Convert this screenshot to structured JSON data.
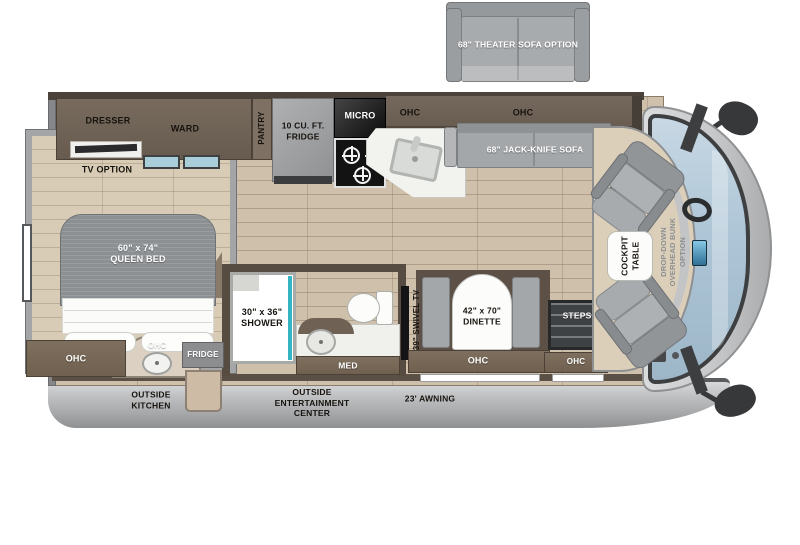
{
  "colors": {
    "cabinet_brown": "#6b5e52",
    "floor_wood": "#cfc0ab",
    "seat_gray": "#a3a6a8",
    "windshield_blue": "#a9c2d3",
    "skirt_gray": "#b9bbbd",
    "accent_teal": "#35b4c4"
  },
  "floorplan": {
    "options": {
      "theater_sofa": "68\" THEATER SOFA OPTION",
      "tv_option": "TV OPTION",
      "cockpit_table": "COCKPIT\nTABLE",
      "bunk_option": "DROP-DOWN\nOVERHEAD BUNK\nOPTION"
    },
    "galley": {
      "dresser": "DRESSER",
      "ward": "WARD",
      "pantry": "PANTRY",
      "fridge": "10 CU. FT.\nFRIDGE",
      "micro": "MICRO",
      "ohc_1": "OHC",
      "ohc_2": "OHC"
    },
    "living": {
      "jackknife_sofa": "68\" JACK-KNIFE SOFA",
      "dinette": "42\" x 70\"\nDINETTE",
      "dinette_ohc": "OHC",
      "swivel_tv": "39\" SWIVEL TV",
      "steps": "STEPS",
      "entry_ohc": "OHC"
    },
    "bedroom": {
      "queen_bed": "60\" x 74\"\nQUEEN BED",
      "ohc": "OHC"
    },
    "bathroom": {
      "shower": "30\" x 36\"\nSHOWER",
      "med": "MED"
    },
    "exterior": {
      "outside_kitchen": "OUTSIDE\nKITCHEN",
      "kitchen_ohc": "OHC",
      "kitchen_fridge": "FRIDGE",
      "entertainment": "OUTSIDE\nENTERTAINMENT\nCENTER",
      "awning": "23' AWNING"
    }
  }
}
